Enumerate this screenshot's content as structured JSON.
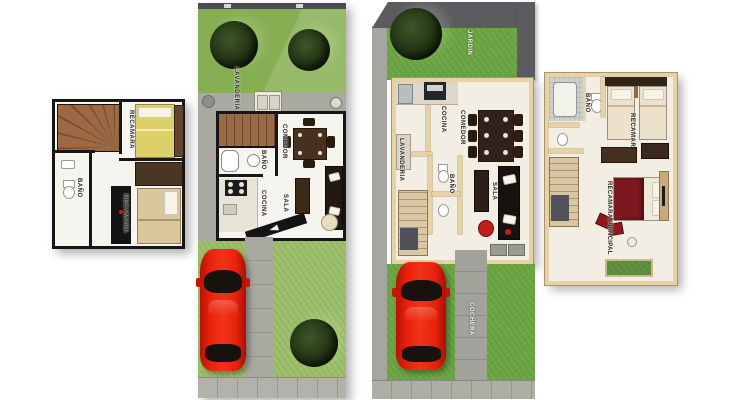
{
  "document": {
    "kind": "house floor-plan sheet",
    "background": "#ffffff"
  },
  "colors": {
    "grass_light": "#9dc06a",
    "grass_mid": "#86af53",
    "grass_dark": "#6ca743",
    "concrete": "#a9a8a1",
    "sidewalk": "#b2b1aa",
    "perimeter_wall": "#5b5b60",
    "plan_wall_black": "#161616",
    "plan_wall_cream": "#e6d2a6",
    "floor_white": "#f6f4ee",
    "floor_cream": "#f3eee3",
    "car_red": "#e8220c",
    "tree_green": "#223617",
    "bed_yellow": "#ddd069",
    "bed_tan": "#d9c79e",
    "bed_maroon": "#7e1820"
  },
  "panels": {
    "upper_floor_left": {
      "labels": {
        "bedroom_top": "RECAMARA",
        "bath": "BAÑO",
        "bedroom_bottom": "RECAMARA"
      }
    },
    "ground_floor_left": {
      "labels": {
        "laundry": "LAVANDERIA",
        "bath": "BAÑO",
        "dining": "COMEDOR",
        "kitchen": "COCINA",
        "living": "SALA"
      }
    },
    "ground_floor_right": {
      "labels": {
        "garden": "JARDIN",
        "kitchen": "COCINA",
        "dining": "COMEDOR",
        "laundry": "LAVANDERIA",
        "bath": "BAÑO",
        "living": "SALA",
        "carport": "COCHERA"
      }
    },
    "upper_floor_right": {
      "labels": {
        "bath": "BAÑO",
        "bedroom": "RECAMARA",
        "master_bedroom": "RECAMARA PRINCIPAL"
      }
    }
  }
}
